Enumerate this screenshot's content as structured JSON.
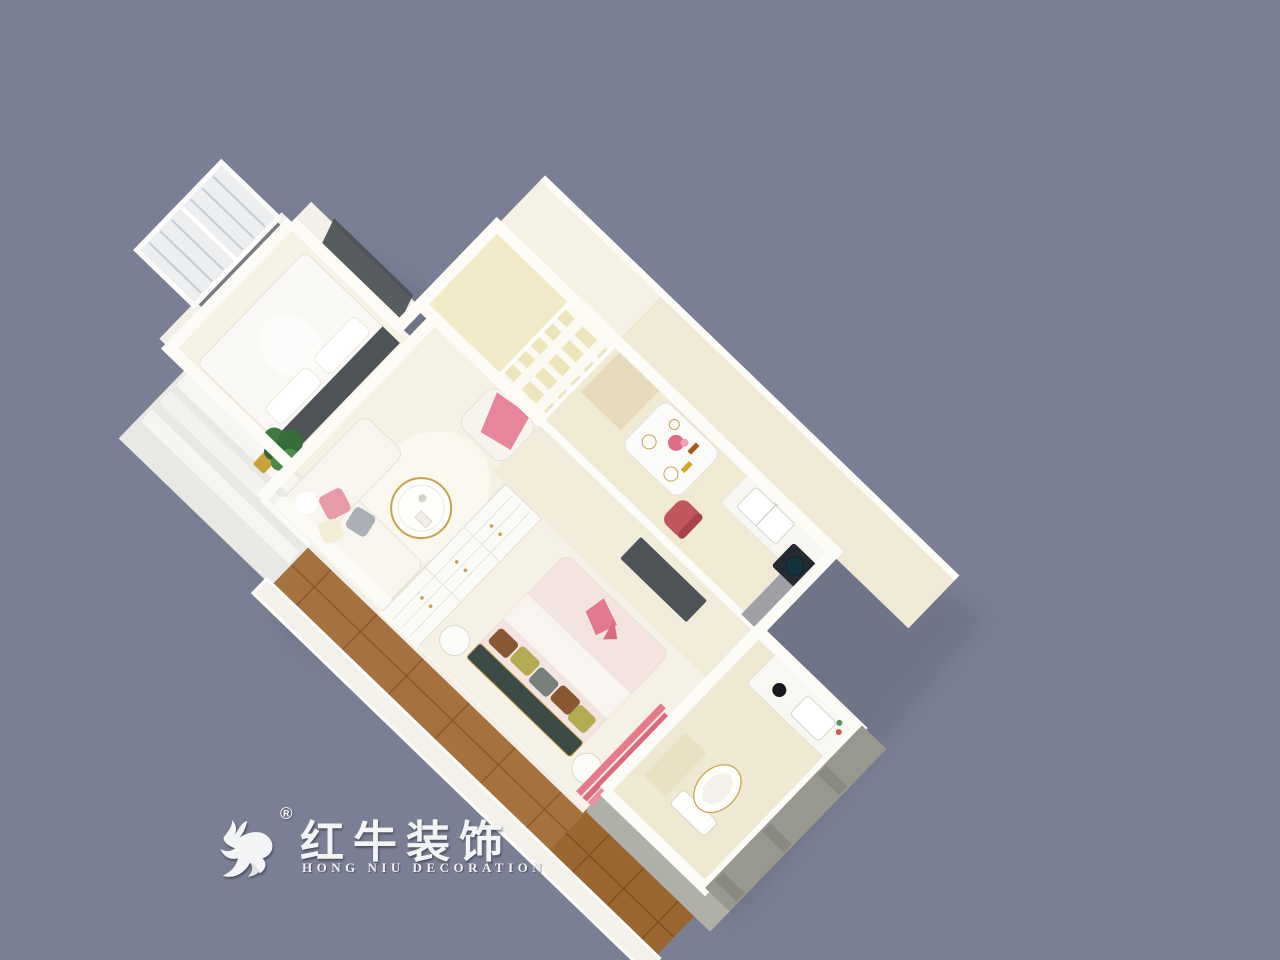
{
  "logo": {
    "icon": "bull-logo-icon",
    "registered_mark": "®",
    "brand_cn": "红牛装饰",
    "brand_en": "HONG NIU DECORATION"
  },
  "colors": {
    "bg": "#7a7f93",
    "shadow": "#65687a",
    "wall": "#fcfbf6",
    "wall_face": "#efe9d6",
    "floor_cream": "#f5f1e4",
    "floor_yellow": "#f2e9c8",
    "floor_kitchen": "#f0e9d3",
    "floor_bath": "#efe8d2",
    "wood": "#a5713f",
    "wood_dark": "#99662f",
    "dark_panel": "#4e5357",
    "accent_pink": "#e79aa8",
    "pink_deep": "#d96c7c",
    "red_chair": "#c2555e",
    "gold": "#c9a24a",
    "plant_green": "#3e7a42",
    "gray_wall": "#99988e",
    "bed_pink": "#f4e4e0",
    "teal_bench": "#3d4b47",
    "olive": "#b3ab52",
    "brown": "#8a5733",
    "pillow_gray": "#aab0b6"
  }
}
